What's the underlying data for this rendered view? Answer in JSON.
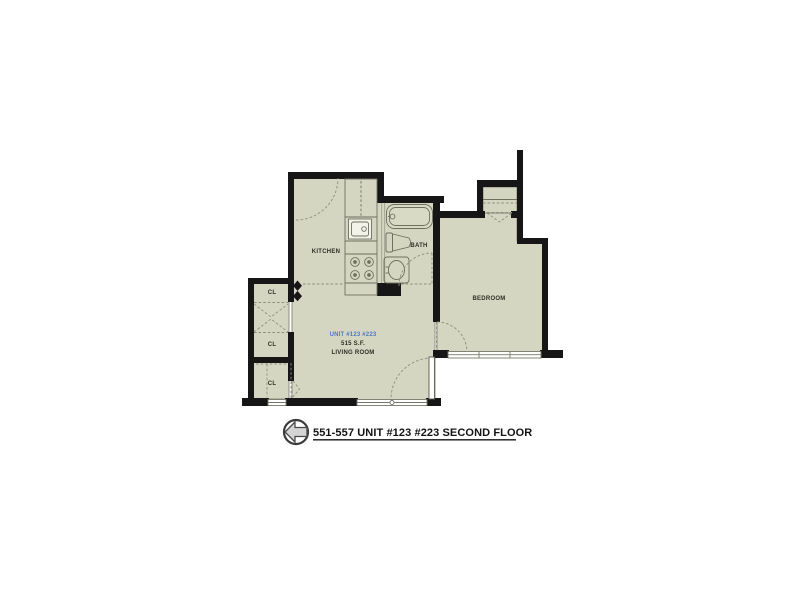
{
  "floor_plan": {
    "title": "551-557 UNIT #123 #223 SECOND FLOOR",
    "rooms": {
      "kitchen": {
        "label": "KITCHEN"
      },
      "bath": {
        "label": "BATH"
      },
      "bedroom": {
        "label": "BEDROOM"
      },
      "living_room": {
        "unit_label": "UNIT #123 #223",
        "area_label": "515 S.F.",
        "area_sf": 515,
        "label": "LIVING ROOM"
      },
      "closets": [
        {
          "label": "CL"
        },
        {
          "label": "CL"
        },
        {
          "label": "CL"
        }
      ]
    },
    "fixtures": [
      "kitchen-sink",
      "stove",
      "bathtub",
      "toilet",
      "bath-sink",
      "kitchen-counter",
      "patio-door",
      "windows",
      "door-swings",
      "closet-bifold-doors"
    ],
    "icons": {
      "north_arrow": "left-arrow-compass-icon"
    },
    "colors": {
      "room_fill": "#d5d6c1",
      "wall": "#161616",
      "accent_blue": "#4b7ac6",
      "fixture_line": "#6f6f60",
      "dash_line": "#8f8f7d"
    }
  }
}
